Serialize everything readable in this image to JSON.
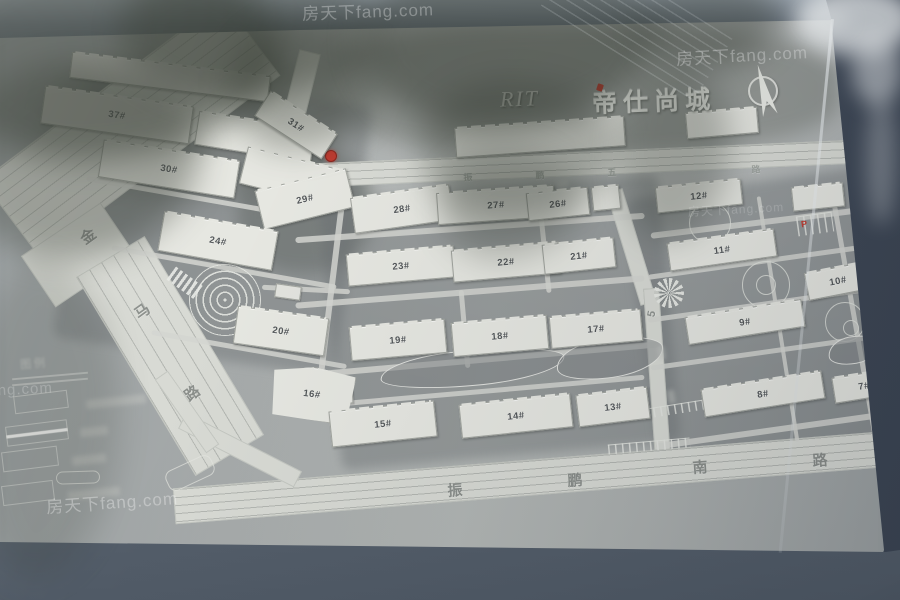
{
  "sign": {
    "logo": "RIT",
    "title": "帝仕尚城",
    "legend_title": "图例",
    "watermark": "房天下fang.com",
    "compass": "north-arrow",
    "road_names": {
      "west": "金马路",
      "north": "振鹏五路",
      "south": "振鹏南路",
      "middle": "5"
    },
    "building_numbers": [
      "7#",
      "8#",
      "9#",
      "10#",
      "11#",
      "12#",
      "13#",
      "14#",
      "15#",
      "16#",
      "17#",
      "18#",
      "19#",
      "20#",
      "21#",
      "22#",
      "23#",
      "24#",
      "26#",
      "27#",
      "28#",
      "29#",
      "30#",
      "31#",
      "37#"
    ],
    "colors": {
      "accent_red": "#c23b30",
      "plate_gray": "#a8acaa",
      "frame_blue_gray": "#4c5664",
      "building_white": "#e6e7e1"
    }
  },
  "map": {
    "buildings": [
      {
        "l": "",
        "x": 70,
        "y": 64,
        "w": 200,
        "h": 26,
        "rot": 7,
        "s": 4
      },
      {
        "l": "37#",
        "x": 42,
        "y": 96,
        "w": 150,
        "h": 38,
        "rot": 8,
        "s": 3
      },
      {
        "l": "",
        "x": 196,
        "y": 120,
        "w": 118,
        "h": 34,
        "rot": 9,
        "s": 2
      },
      {
        "l": "30#",
        "x": 100,
        "y": 150,
        "w": 138,
        "h": 38,
        "rot": 9,
        "s": 3
      },
      {
        "l": "",
        "x": 242,
        "y": 158,
        "w": 100,
        "h": 38,
        "rot": 14,
        "s": 2
      },
      {
        "l": "31#",
        "x": 256,
        "y": 110,
        "w": 80,
        "h": 30,
        "rot": 33,
        "s": 2
      },
      {
        "l": "29#",
        "x": 258,
        "y": 179,
        "w": 94,
        "h": 40,
        "rot": -14,
        "s": 2
      },
      {
        "l": "28#",
        "x": 352,
        "y": 191,
        "w": 100,
        "h": 36,
        "rot": -8,
        "s": 2
      },
      {
        "l": "27#",
        "x": 437,
        "y": 189,
        "w": 118,
        "h": 32,
        "rot": -4,
        "s": 3
      },
      {
        "l": "26#",
        "x": 527,
        "y": 190,
        "w": 62,
        "h": 28,
        "rot": -6,
        "s": 2
      },
      {
        "l": "",
        "x": 592,
        "y": 186,
        "w": 28,
        "h": 24,
        "rot": -6,
        "s": 1
      },
      {
        "l": "",
        "x": 455,
        "y": 122,
        "w": 170,
        "h": 30,
        "rot": -4,
        "s": 3
      },
      {
        "l": "",
        "x": 686,
        "y": 110,
        "w": 72,
        "h": 26,
        "rot": -5,
        "s": 2
      },
      {
        "l": "24#",
        "x": 160,
        "y": 221,
        "w": 116,
        "h": 40,
        "rot": 10,
        "s": 3
      },
      {
        "l": "23#",
        "x": 347,
        "y": 250,
        "w": 108,
        "h": 32,
        "rot": -5,
        "s": 3
      },
      {
        "l": "22#",
        "x": 452,
        "y": 246,
        "w": 108,
        "h": 32,
        "rot": -5,
        "s": 3
      },
      {
        "l": "21#",
        "x": 543,
        "y": 241,
        "w": 72,
        "h": 30,
        "rot": -6,
        "s": 2
      },
      {
        "l": "20#",
        "x": 235,
        "y": 312,
        "w": 92,
        "h": 38,
        "rot": 8,
        "s": 3
      },
      {
        "l": "19#",
        "x": 350,
        "y": 323,
        "w": 96,
        "h": 34,
        "rot": -5,
        "s": 2
      },
      {
        "l": "18#",
        "x": 452,
        "y": 319,
        "w": 96,
        "h": 34,
        "rot": -5,
        "s": 2
      },
      {
        "l": "17#",
        "x": 550,
        "y": 313,
        "w": 92,
        "h": 32,
        "rot": -5,
        "s": 3
      },
      {
        "l": "16#",
        "x": 270,
        "y": 367,
        "w": 84,
        "h": 54,
        "rot": 7,
        "s": 1,
        "big": 1
      },
      {
        "l": "15#",
        "x": 330,
        "y": 406,
        "w": 106,
        "h": 36,
        "rot": -6,
        "s": 3
      },
      {
        "l": "14#",
        "x": 460,
        "y": 399,
        "w": 112,
        "h": 34,
        "rot": -6,
        "s": 3
      },
      {
        "l": "13#",
        "x": 577,
        "y": 391,
        "w": 72,
        "h": 32,
        "rot": -7,
        "s": 2
      },
      {
        "l": "12#",
        "x": 656,
        "y": 183,
        "w": 86,
        "h": 26,
        "rot": -6,
        "s": 3
      },
      {
        "l": "",
        "x": 792,
        "y": 185,
        "w": 52,
        "h": 24,
        "rot": -6,
        "s": 2
      },
      {
        "l": "11#",
        "x": 668,
        "y": 236,
        "w": 108,
        "h": 28,
        "rot": -8,
        "s": 4
      },
      {
        "l": "10#",
        "x": 806,
        "y": 267,
        "w": 64,
        "h": 28,
        "rot": -11,
        "s": 2
      },
      {
        "l": "9#",
        "x": 686,
        "y": 308,
        "w": 118,
        "h": 28,
        "rot": -9,
        "s": 4
      },
      {
        "l": "8#",
        "x": 702,
        "y": 380,
        "w": 122,
        "h": 28,
        "rot": -9,
        "s": 4
      },
      {
        "l": "7#",
        "x": 833,
        "y": 373,
        "w": 62,
        "h": 26,
        "rot": -9,
        "s": 2
      }
    ],
    "shapes": [
      {
        "c": "mottle",
        "x": 320,
        "y": 24,
        "w": 520,
        "h": 130
      },
      {
        "c": "mottle",
        "x": 46,
        "y": 54,
        "w": 290,
        "h": 145
      },
      {
        "c": "mottle2",
        "x": 238,
        "y": 148,
        "w": 135,
        "h": 125
      },
      {
        "c": "ground",
        "x": 70,
        "y": 86,
        "w": 285,
        "h": 272,
        "rot": 8
      },
      {
        "c": "ground",
        "x": 330,
        "y": 188,
        "w": 340,
        "h": 268,
        "rot": -5
      },
      {
        "c": "ground",
        "x": 642,
        "y": 182,
        "w": 246,
        "h": 282,
        "rot": -8
      },
      {
        "c": "road lanes-A",
        "x": -20,
        "y": 80,
        "w": 302,
        "h": 96,
        "rot": -37,
        "n": "jinma-road-upper"
      },
      {
        "c": "road",
        "x": 30,
        "y": 224,
        "w": 96,
        "h": 62,
        "rot": -34
      },
      {
        "c": "road lanes-B",
        "x": 130,
        "y": 240,
        "w": 80,
        "h": 232,
        "rot": -31,
        "n": "jinma-road-lower"
      },
      {
        "c": "road",
        "x": 284,
        "y": 50,
        "w": 22,
        "h": 125,
        "rot": 14
      },
      {
        "c": "road lanes-H",
        "x": 287,
        "y": 151,
        "w": 618,
        "h": 24,
        "rot": -2.5,
        "n": "zhenpeng-5-road"
      },
      {
        "c": "road",
        "x": 623,
        "y": 188,
        "w": 17,
        "h": 118,
        "rot": -17,
        "n": "mid-road-upper"
      },
      {
        "c": "road",
        "x": 649,
        "y": 288,
        "w": 16,
        "h": 172,
        "rot": -4,
        "n": "mid-road-lower"
      },
      {
        "c": "road lanes-H",
        "x": 173,
        "y": 459,
        "w": 732,
        "h": 36,
        "rot": -4.6,
        "n": "zhenpeng-south-road"
      },
      {
        "c": "road",
        "x": 175,
        "y": 441,
        "w": 130,
        "h": 18,
        "rot": 27
      },
      {
        "c": "road",
        "x": 142,
        "y": 404,
        "w": 90,
        "h": 16,
        "rot": 55
      },
      {
        "c": "path",
        "x": 295,
        "y": 225,
        "w": 350,
        "h": 6,
        "rot": -4
      },
      {
        "c": "path",
        "x": 295,
        "y": 289,
        "w": 350,
        "h": 6,
        "rot": -4.5
      },
      {
        "c": "path",
        "x": 300,
        "y": 357,
        "w": 360,
        "h": 6,
        "rot": -5
      },
      {
        "c": "path",
        "x": 295,
        "y": 390,
        "w": 350,
        "h": 5,
        "rot": -5
      },
      {
        "c": "path",
        "x": 327,
        "y": 195,
        "w": 6,
        "h": 212,
        "rot": 7
      },
      {
        "c": "path",
        "x": 542,
        "y": 205,
        "w": 5,
        "h": 88,
        "rot": -6
      },
      {
        "c": "path",
        "x": 462,
        "y": 290,
        "w": 5,
        "h": 78,
        "rot": -5
      },
      {
        "c": "path",
        "x": 650,
        "y": 219,
        "w": 228,
        "h": 6,
        "rot": -7
      },
      {
        "c": "path",
        "x": 647,
        "y": 259,
        "w": 228,
        "h": 5,
        "rot": -8
      },
      {
        "c": "path",
        "x": 647,
        "y": 302,
        "w": 228,
        "h": 5,
        "rot": -8
      },
      {
        "c": "path",
        "x": 650,
        "y": 349,
        "w": 238,
        "h": 5,
        "rot": -8
      },
      {
        "c": "path",
        "x": 655,
        "y": 427,
        "w": 238,
        "h": 6,
        "rot": -8
      },
      {
        "c": "path",
        "x": 852,
        "y": 195,
        "w": 5,
        "h": 248,
        "rot": -10
      },
      {
        "c": "path",
        "x": 776,
        "y": 195,
        "w": 4,
        "h": 248,
        "rot": -9
      },
      {
        "c": "path",
        "x": 85,
        "y": 195,
        "w": 218,
        "h": 5,
        "rot": 10
      },
      {
        "c": "path",
        "x": 110,
        "y": 265,
        "w": 228,
        "h": 5,
        "rot": 10
      },
      {
        "c": "path",
        "x": 150,
        "y": 347,
        "w": 198,
        "h": 5,
        "rot": 10
      },
      {
        "c": "path",
        "x": 262,
        "y": 287,
        "w": 88,
        "h": 5,
        "rot": 3
      },
      {
        "c": "plaza",
        "x": 189,
        "y": 264,
        "w": 72,
        "h": 72,
        "n": "entrance-plaza"
      },
      {
        "c": "sunflower",
        "x": 654,
        "y": 278,
        "w": 30,
        "h": 30,
        "n": "roundabout"
      },
      {
        "c": "ring",
        "x": 689,
        "y": 202,
        "w": 42,
        "h": 42
      },
      {
        "c": "ring",
        "x": 742,
        "y": 261,
        "w": 48,
        "h": 48
      },
      {
        "c": "ring",
        "x": 756,
        "y": 275,
        "w": 20,
        "h": 20
      },
      {
        "c": "ring",
        "x": 825,
        "y": 302,
        "w": 40,
        "h": 40
      },
      {
        "c": "ring",
        "x": 843,
        "y": 320,
        "w": 16,
        "h": 16
      },
      {
        "c": "pond",
        "x": 380,
        "y": 350,
        "w": 185,
        "h": 36,
        "rot": -5,
        "n": "central-pond"
      },
      {
        "c": "pond",
        "x": 556,
        "y": 338,
        "w": 108,
        "h": 40,
        "rot": -8,
        "n": "central-pond"
      },
      {
        "c": "pond",
        "x": 828,
        "y": 336,
        "w": 52,
        "h": 28,
        "rot": -10
      },
      {
        "c": "crossw",
        "x": 168,
        "y": 275,
        "w": 34,
        "h": 16,
        "rot": 36,
        "n": "crosswalk"
      },
      {
        "c": "comb",
        "x": 797,
        "y": 214,
        "w": 36,
        "h": 20,
        "rot": -8,
        "n": "parking-grid"
      },
      {
        "c": "comb",
        "x": 646,
        "y": 399,
        "w": 122,
        "h": 10,
        "rot": -9
      },
      {
        "c": "comb",
        "x": 608,
        "y": 441,
        "w": 82,
        "h": 10,
        "rot": -5
      },
      {
        "c": "bldg-small",
        "x": 327,
        "y": 386,
        "w": 26,
        "h": 18,
        "rot": -3,
        "n": "south-gate"
      },
      {
        "c": "bldg-small",
        "x": 275,
        "y": 285,
        "w": 26,
        "h": 14,
        "rot": 8,
        "n": "gatehouse"
      },
      {
        "c": "outline",
        "x": 56,
        "y": 471,
        "w": 44,
        "h": 13,
        "rot": -2
      },
      {
        "c": "outline",
        "x": 165,
        "y": 462,
        "w": 50,
        "h": 22,
        "rot": -25
      },
      {
        "c": "lline",
        "x": 12,
        "y": 375,
        "w": 76,
        "h": 2,
        "rot": -5
      },
      {
        "c": "lline",
        "x": 12,
        "y": 381,
        "w": 76,
        "h": 2,
        "rot": -5
      },
      {
        "c": "lbox",
        "x": 14,
        "y": 393,
        "w": 54,
        "h": 18,
        "rot": -7,
        "n": "legend-box"
      },
      {
        "c": "lbox lbox-stripe",
        "x": 6,
        "y": 423,
        "w": 62,
        "h": 20,
        "rot": -7,
        "n": "legend-box"
      },
      {
        "c": "lbox",
        "x": 2,
        "y": 449,
        "w": 56,
        "h": 20,
        "rot": -7,
        "n": "legend-box"
      },
      {
        "c": "lbox",
        "x": 2,
        "y": 483,
        "w": 52,
        "h": 20,
        "rot": -7,
        "n": "legend-box"
      },
      {
        "c": "smudge",
        "x": 86,
        "y": 397,
        "w": 60,
        "h": 9,
        "rot": -6,
        "n": "legend-label-smudge"
      },
      {
        "c": "smudge",
        "x": 80,
        "y": 427,
        "w": 28,
        "h": 9,
        "rot": -6,
        "n": "legend-label-smudge"
      },
      {
        "c": "smudge",
        "x": 72,
        "y": 455,
        "w": 34,
        "h": 9,
        "rot": -6,
        "n": "legend-label-smudge"
      },
      {
        "c": "smudge",
        "x": 68,
        "y": 489,
        "w": 52,
        "h": 9,
        "rot": -6,
        "n": "legend-label-smudge"
      },
      {
        "c": "smudge",
        "x": 658,
        "y": 346,
        "w": 7,
        "h": 14,
        "rot": -10
      },
      {
        "c": "smudge",
        "x": 668,
        "y": 390,
        "w": 7,
        "h": 14,
        "rot": -10
      },
      {
        "c": "smudge",
        "x": 556,
        "y": 180,
        "w": 12,
        "h": 8,
        "rot": -5
      },
      {
        "c": "youarehere",
        "x": 325,
        "y": 150,
        "w": 12,
        "h": 12,
        "n": "you-are-here-marker"
      },
      {
        "c": "blob d55",
        "x": -60,
        "y": -50,
        "w": 340,
        "h": 210,
        "L": "ov",
        "n": "tree-reflection"
      },
      {
        "c": "blob d40",
        "x": -40,
        "y": 60,
        "w": 240,
        "h": 200,
        "L": "ov",
        "n": "tree-reflection"
      },
      {
        "c": "blob d45",
        "x": 120,
        "y": -40,
        "w": 260,
        "h": 140,
        "L": "ov",
        "n": "tree-reflection"
      },
      {
        "c": "blob d35",
        "x": 230,
        "y": 20,
        "w": 150,
        "h": 130,
        "L": "ov",
        "n": "tree-reflection"
      },
      {
        "c": "blob d50",
        "x": 360,
        "y": -50,
        "w": 300,
        "h": 180,
        "L": "ov",
        "n": "tree-reflection"
      },
      {
        "c": "blob d30",
        "x": 420,
        "y": 80,
        "w": 200,
        "h": 140,
        "L": "ov",
        "n": "tree-reflection"
      },
      {
        "c": "blob d25",
        "x": 440,
        "y": 150,
        "w": 140,
        "h": 110,
        "L": "ov",
        "n": "tree-reflection"
      },
      {
        "c": "blob d30",
        "x": 620,
        "y": 60,
        "w": 110,
        "h": 180,
        "L": "ov",
        "n": "tree-reflection"
      },
      {
        "c": "blob d40",
        "x": 640,
        "y": -30,
        "w": 140,
        "h": 100,
        "L": "ov",
        "n": "tree-reflection"
      },
      {
        "c": "blob d18",
        "x": -30,
        "y": 260,
        "w": 150,
        "h": 320,
        "L": "ov",
        "n": "shadow"
      },
      {
        "c": "lines-refl",
        "x": 545,
        "y": -15,
        "w": 180,
        "h": 80,
        "rot": 32,
        "L": "ov",
        "n": "glass-reflection-lines"
      },
      {
        "c": "lblob l75",
        "x": 795,
        "y": -15,
        "w": 120,
        "h": 70,
        "L": "ov",
        "n": "sky-reflection"
      },
      {
        "c": "lblob l50",
        "x": 852,
        "y": 35,
        "w": 50,
        "h": 70,
        "L": "ov",
        "n": "sky-reflection"
      },
      {
        "c": "lblob l30",
        "x": 866,
        "y": 95,
        "w": 30,
        "h": 130,
        "L": "ov",
        "n": "sky-reflection"
      },
      {
        "c": "lblob l60",
        "x": 806,
        "y": 12,
        "w": 44,
        "h": 14,
        "L": "ov",
        "n": "plate-corner-highlight"
      }
    ],
    "texts": [
      {
        "c": "rc b1",
        "t": "金",
        "x": 88,
        "y": 236,
        "rot": -36,
        "n": "road-name-char"
      },
      {
        "c": "rc b1",
        "t": "马",
        "x": 142,
        "y": 311,
        "rot": -36,
        "n": "road-name-char"
      },
      {
        "c": "rc b1",
        "t": "路",
        "x": 192,
        "y": 393,
        "rot": -36,
        "n": "road-name-char"
      },
      {
        "c": "rc b1",
        "t": "振",
        "x": 455,
        "y": 490,
        "rot": -4,
        "n": "road-name-char"
      },
      {
        "c": "rc b1",
        "t": "鹏",
        "x": 575,
        "y": 480,
        "rot": -4,
        "n": "road-name-char"
      },
      {
        "c": "rc b1",
        "t": "南",
        "x": 700,
        "y": 467,
        "rot": -4,
        "n": "road-name-char"
      },
      {
        "c": "rc b1",
        "t": "路",
        "x": 820,
        "y": 460,
        "rot": -4,
        "n": "road-name-char"
      },
      {
        "c": "rc s1",
        "t": "振",
        "x": 468,
        "y": 177,
        "rot": -3,
        "n": "road-name-char"
      },
      {
        "c": "rc s1",
        "t": "鹏",
        "x": 540,
        "y": 175,
        "rot": -3,
        "n": "road-name-char"
      },
      {
        "c": "rc s1",
        "t": "五",
        "x": 612,
        "y": 172,
        "rot": -3,
        "n": "road-name-char"
      },
      {
        "c": "rc s1",
        "t": "路",
        "x": 756,
        "y": 169,
        "rot": -3,
        "n": "road-name-char"
      },
      {
        "c": "rc m1",
        "t": "5",
        "x": 652,
        "y": 314,
        "rot": -78,
        "n": "road-name-char"
      },
      {
        "c": "pmark",
        "t": "P",
        "x": 804,
        "y": 224,
        "rot": -8,
        "n": "parking-label"
      },
      {
        "c": "pmark sm2",
        "t": "P",
        "x": 877,
        "y": 287,
        "rot": -8,
        "n": "parking-label"
      },
      {
        "c": "wm",
        "t": "房天下fang.com",
        "x": 368,
        "y": 10,
        "rot": -2,
        "fs": 17,
        "op": 0.3,
        "L": "ov",
        "n": "watermark"
      },
      {
        "c": "wm",
        "t": "房天下fang.com",
        "x": 742,
        "y": 54,
        "rot": -3,
        "fs": 17,
        "op": 0.33,
        "L": "ov",
        "n": "watermark"
      },
      {
        "c": "wm",
        "t": "房天下fang.com",
        "x": 112,
        "y": 501,
        "rot": -4,
        "fs": 17,
        "op": 0.33,
        "L": "ov",
        "n": "watermark"
      },
      {
        "c": "wm",
        "t": "房天下fang.com",
        "x": -6,
        "y": 390,
        "rot": -3,
        "fs": 15,
        "op": 0.22,
        "L": "ov",
        "n": "watermark"
      },
      {
        "c": "wm",
        "t": "房天下fang.com",
        "x": 736,
        "y": 209,
        "rot": -3,
        "fs": 12,
        "op": 0.2,
        "L": "ov",
        "n": "watermark"
      }
    ]
  }
}
